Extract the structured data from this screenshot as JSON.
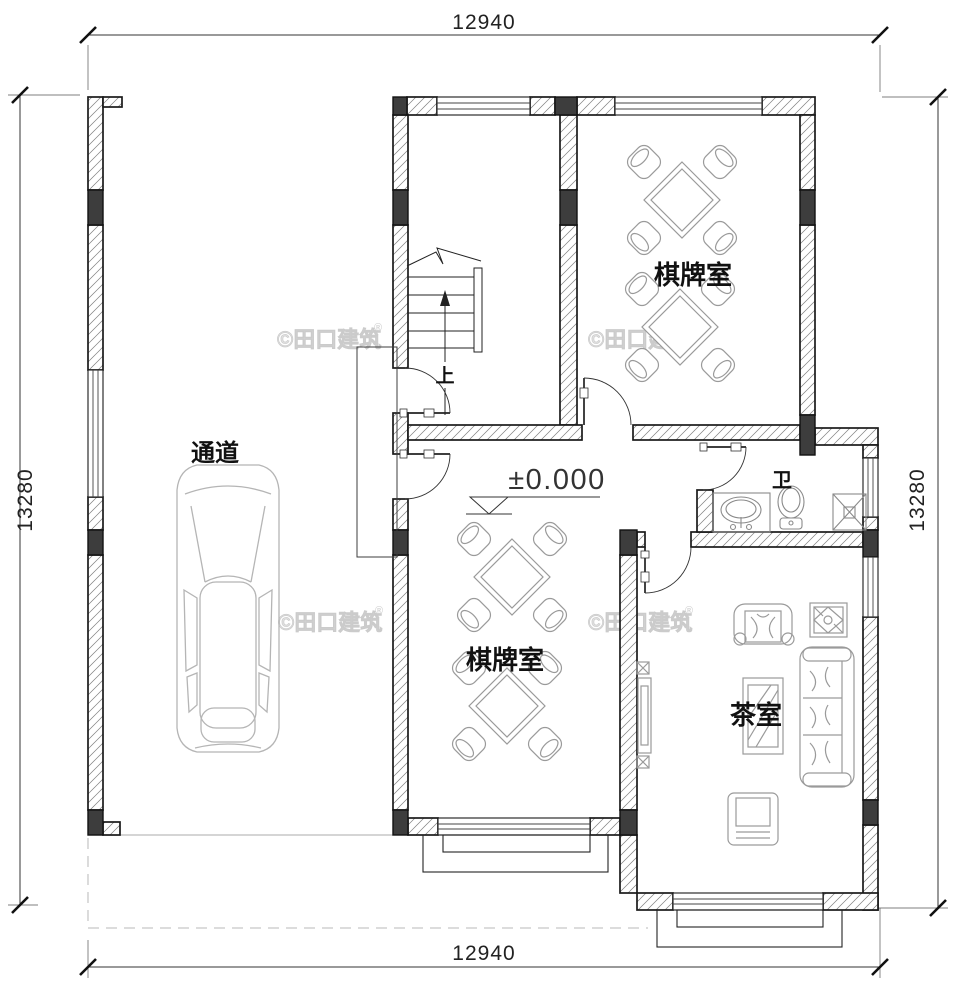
{
  "dimensions": {
    "top": "12940",
    "bottom": "12940",
    "left": "13280",
    "right": "13280"
  },
  "rooms": {
    "chess_upper": "棋牌室",
    "chess_lower": "棋牌室",
    "tea": "茶室",
    "passage": "通道",
    "bath": "卫"
  },
  "annotations": {
    "elevation": "±0.000",
    "up": "上"
  },
  "watermark": {
    "text": "©田口建筑",
    "reg": "®"
  },
  "colors": {
    "wall_line": "#1a1a1a",
    "column_fill": "#3d3d3d",
    "furniture": "#9a9a9a",
    "watermark": "#e0e0e0",
    "dashed": "#c8c8c8"
  }
}
